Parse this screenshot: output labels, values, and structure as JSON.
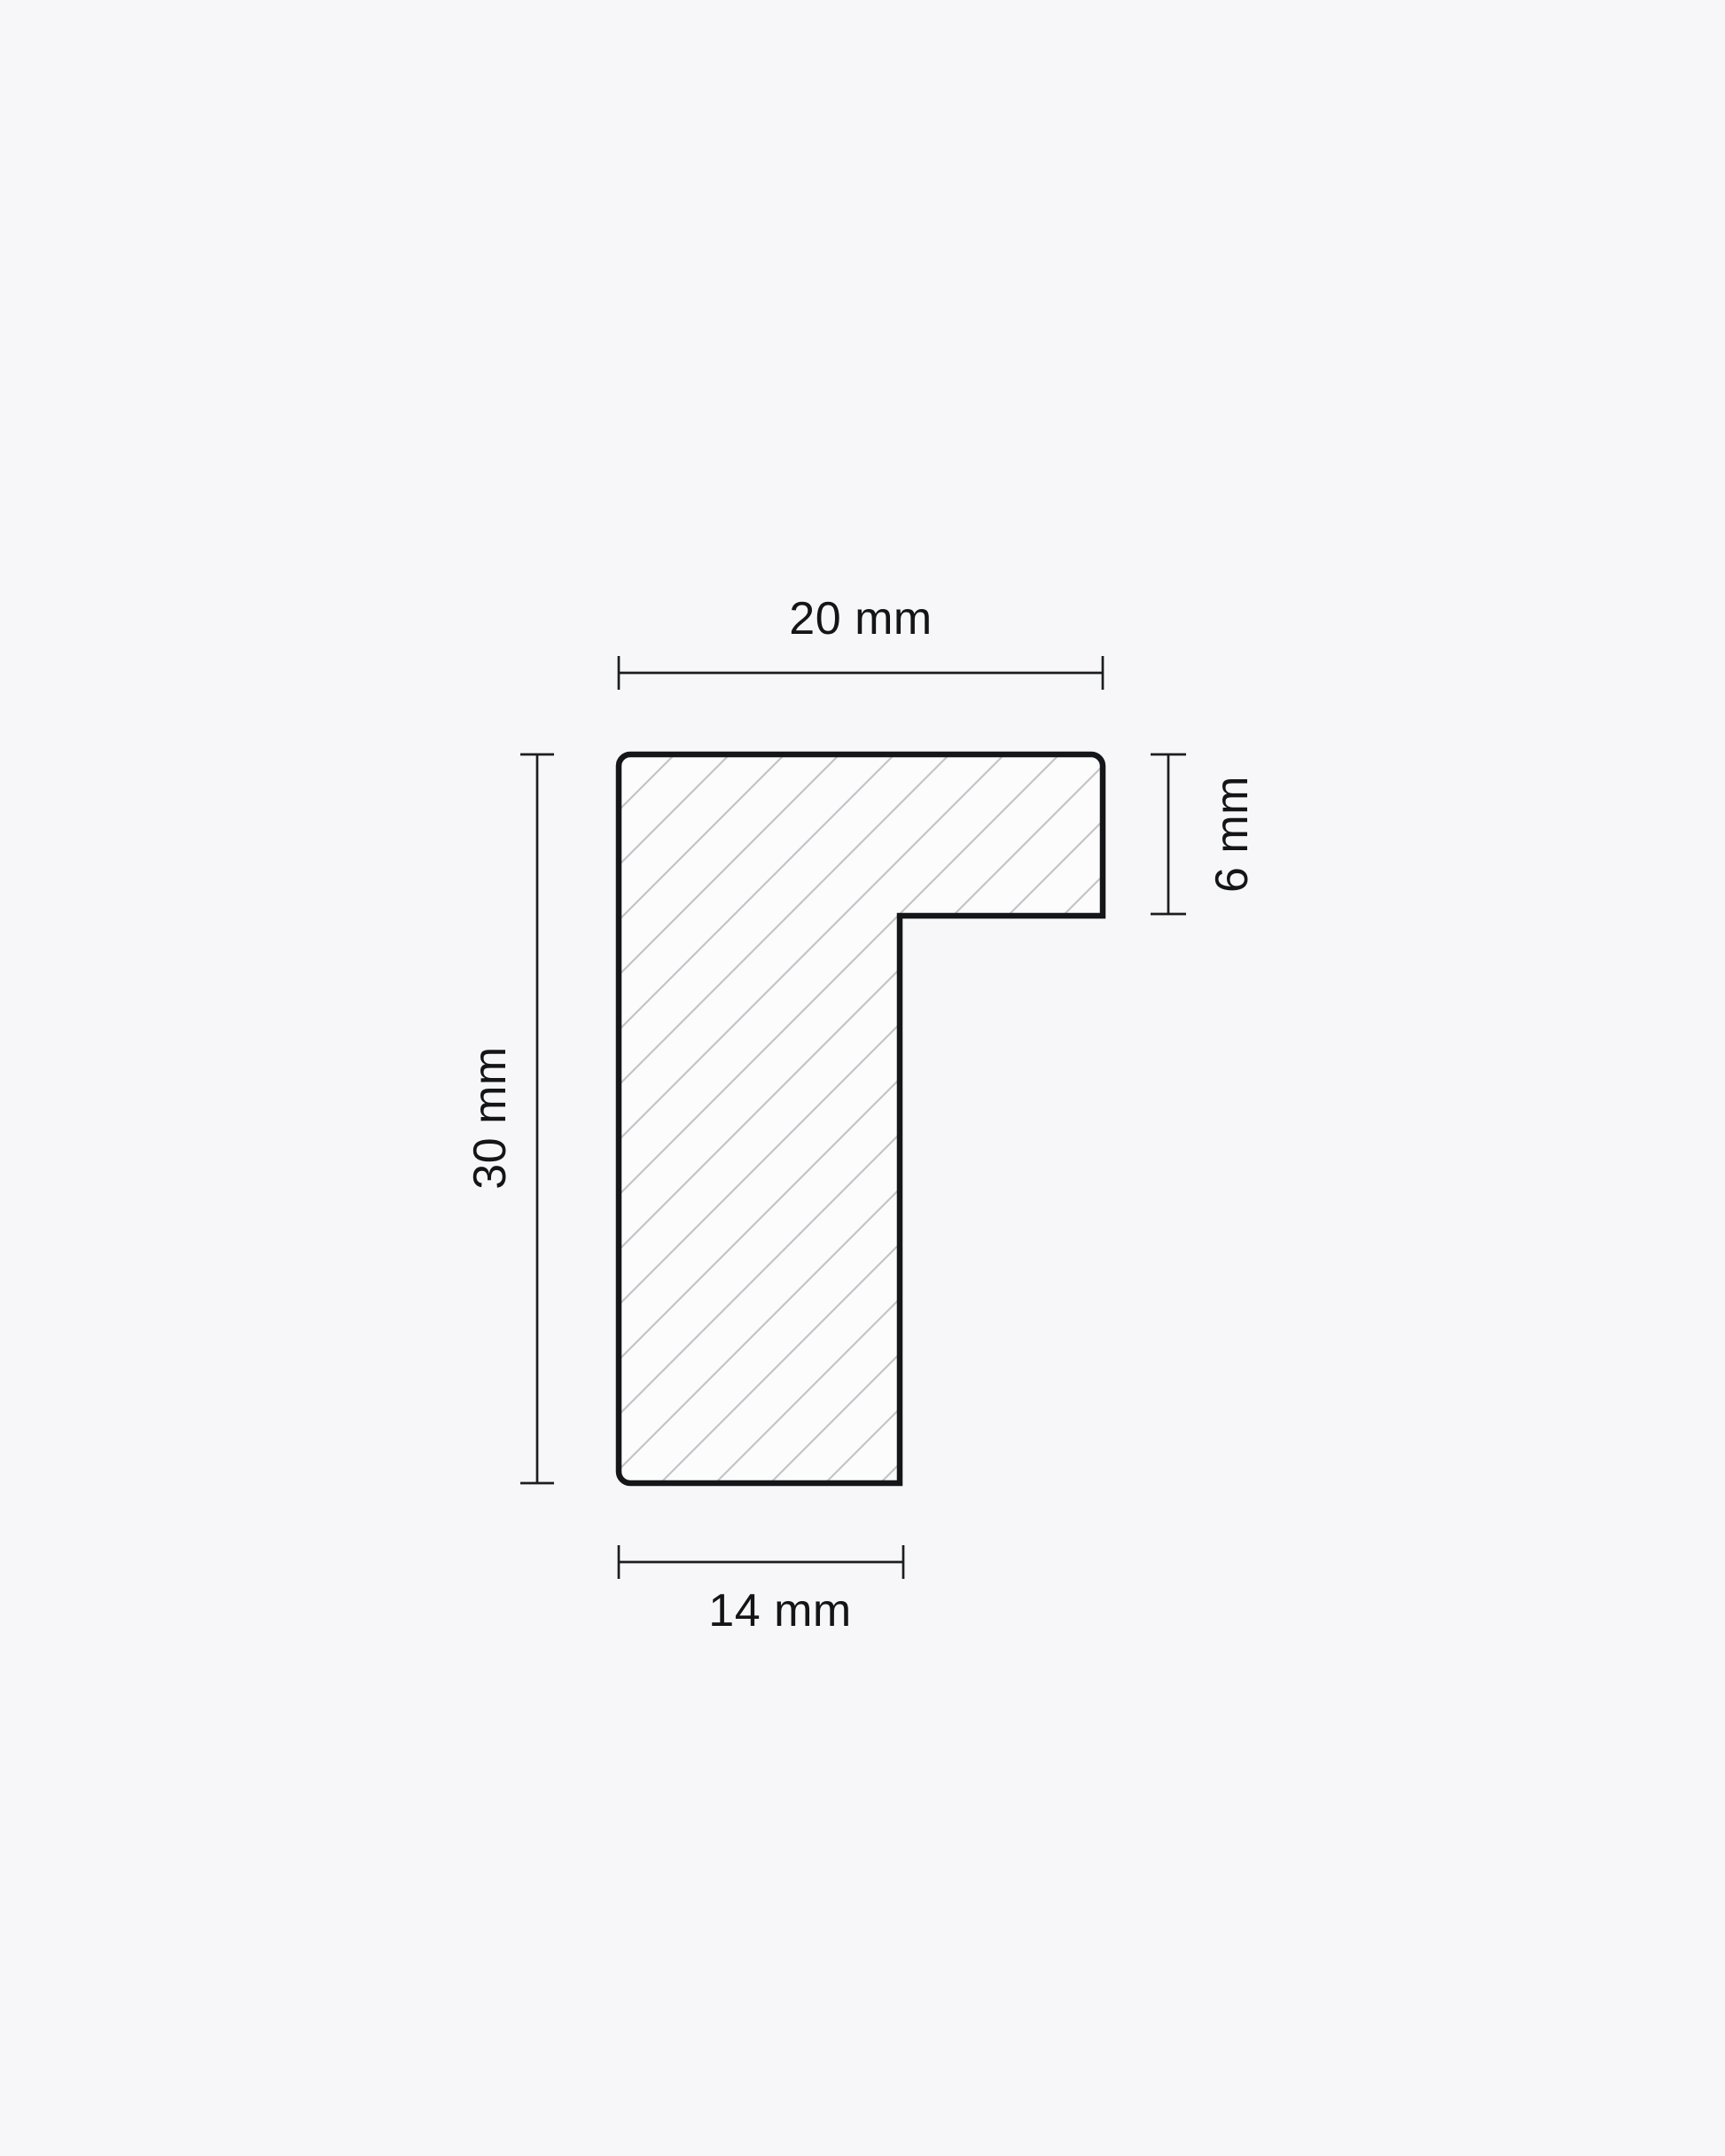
{
  "page": {
    "background_color": "#f7f7f9"
  },
  "drawing": {
    "kind": "cross-section-profile",
    "colors": {
      "outline": "#151619",
      "hatch": "#c4c4c8",
      "shape_fill": "#fcfcfd",
      "dimension_line": "#1c1d20",
      "label_text": "#141519"
    },
    "dimensions": {
      "width_top": {
        "label": "20 mm"
      },
      "height_left": {
        "label": "30 mm"
      },
      "height_right": {
        "label": "6 mm"
      },
      "width_bottom": {
        "label": "14 mm"
      }
    }
  }
}
